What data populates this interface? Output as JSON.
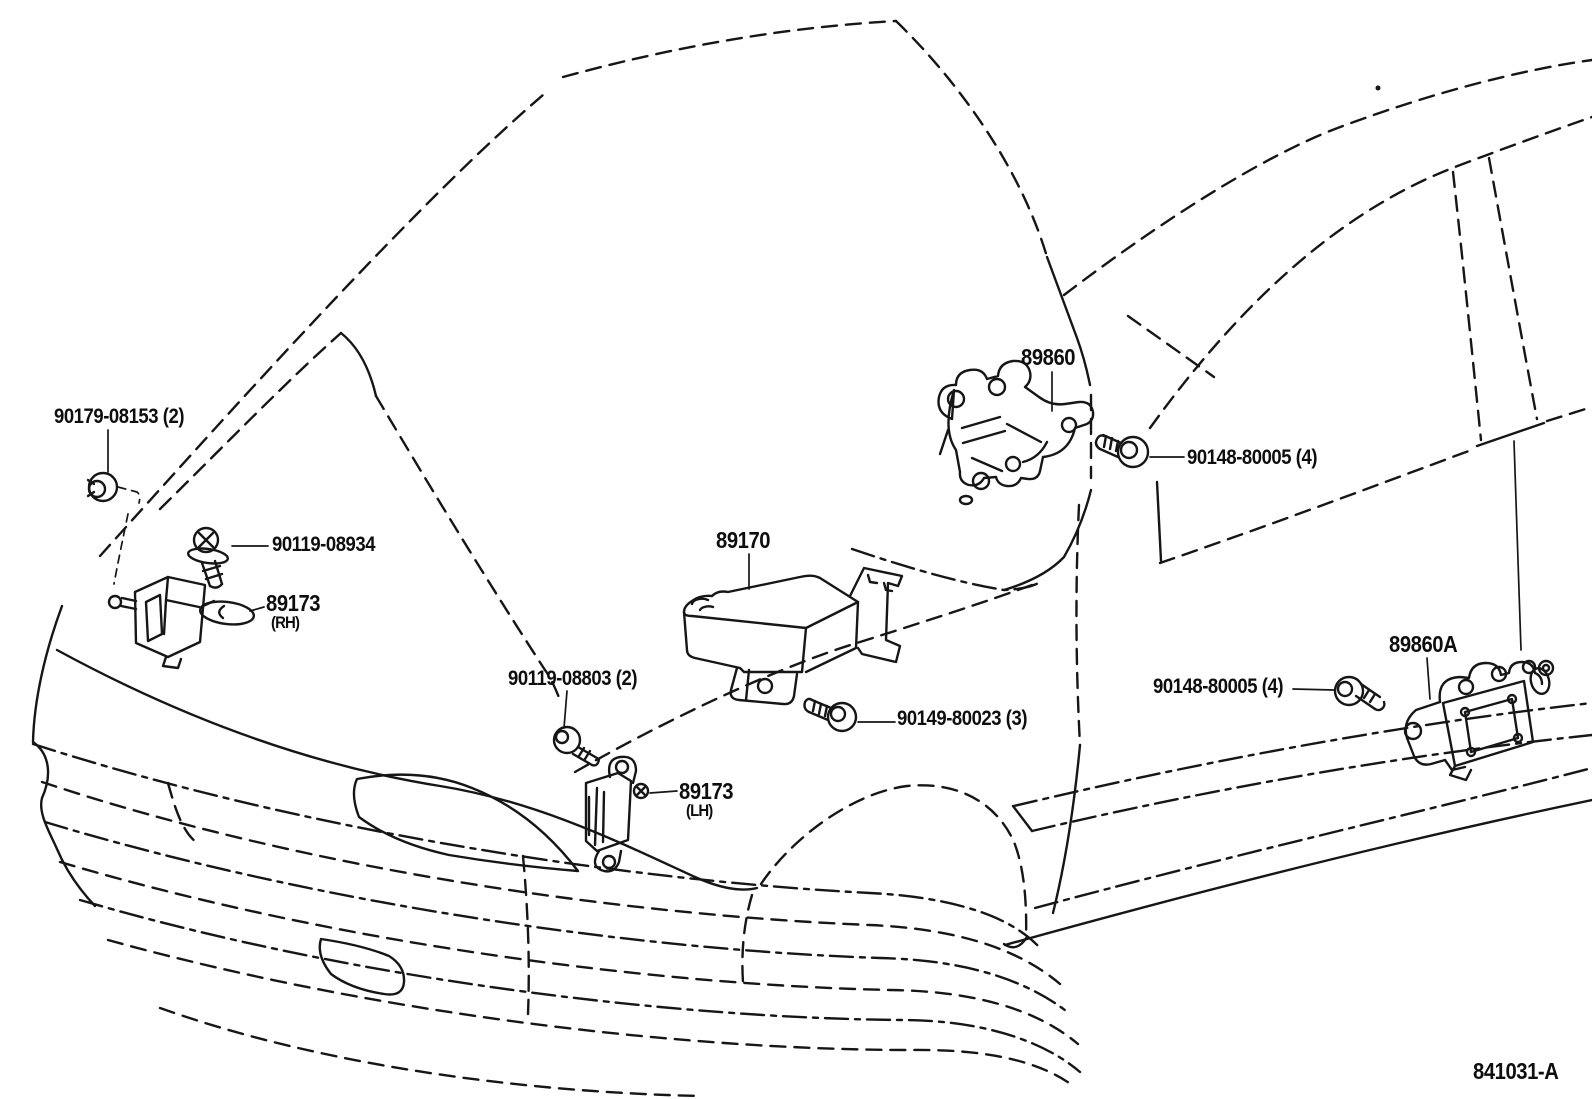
{
  "figure": {
    "code": "841031-A",
    "description_visible_text_only": true
  },
  "colors": {
    "background": "#ffffff",
    "line": "#161616"
  },
  "labels": [
    {
      "id": "label-90179-08153",
      "text": "90179-08153 (2)"
    },
    {
      "id": "label-90119-08934",
      "text": "90119-08934"
    },
    {
      "id": "label-89173-rh",
      "text": "89173"
    },
    {
      "id": "label-89173-rh-side",
      "text": "(RH)"
    },
    {
      "id": "label-90119-08803",
      "text": "90119-08803 (2)"
    },
    {
      "id": "label-89173-lh",
      "text": "89173"
    },
    {
      "id": "label-89173-lh-side",
      "text": "(LH)"
    },
    {
      "id": "label-89170",
      "text": "89170"
    },
    {
      "id": "label-90149-80023",
      "text": "90149-80023 (3)"
    },
    {
      "id": "label-89860",
      "text": "89860"
    },
    {
      "id": "label-90148-80005-right",
      "text": "90148-80005 (4)"
    },
    {
      "id": "label-90148-80005-left",
      "text": "90148-80005 (4)"
    },
    {
      "id": "label-89860a",
      "text": "89860A"
    },
    {
      "id": "label-figure-code",
      "text": "841031-A"
    }
  ],
  "parts": [
    {
      "part_number": "90179-08153",
      "quantity": "2"
    },
    {
      "part_number": "90119-08934",
      "quantity": "1"
    },
    {
      "part_number": "89173",
      "side": "RH"
    },
    {
      "part_number": "90119-08803",
      "quantity": "2"
    },
    {
      "part_number": "89173",
      "side": "LH"
    },
    {
      "part_number": "89170"
    },
    {
      "part_number": "90149-80023",
      "quantity": "3"
    },
    {
      "part_number": "89860"
    },
    {
      "part_number": "90148-80005",
      "quantity": "4"
    },
    {
      "part_number": "89860A"
    }
  ]
}
